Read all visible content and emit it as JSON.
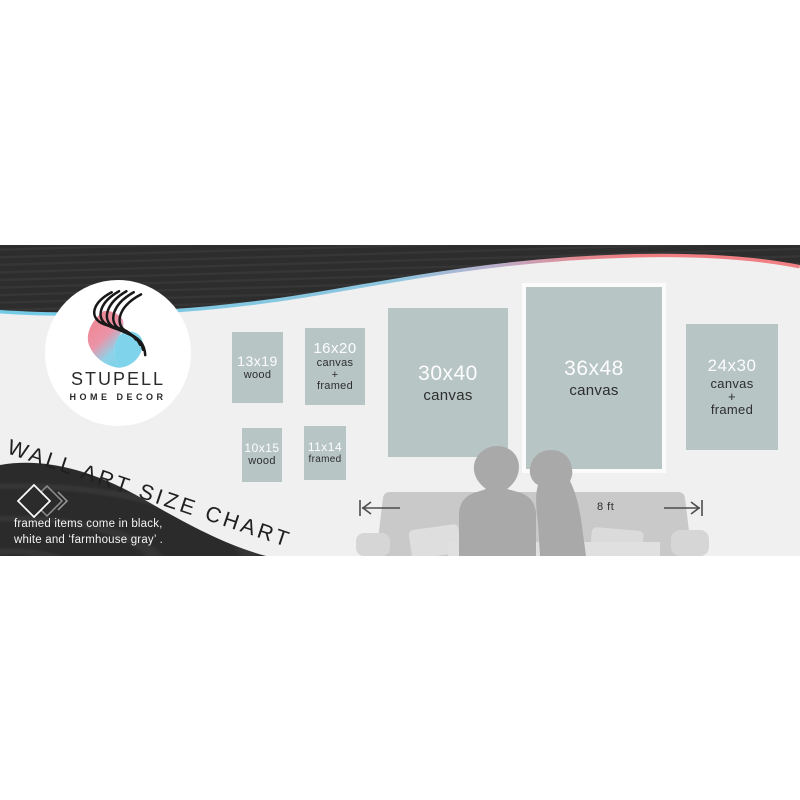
{
  "brand": {
    "name": "STUPELL",
    "tagline": "HOME DECOR"
  },
  "title": "WALL ART SIZE CHART",
  "note": {
    "line1": "framed items come in black,",
    "line2": "white and ‘farmhouse gray’ ."
  },
  "sizes": [
    {
      "size": "13x19",
      "material": "wood"
    },
    {
      "size": "16x20",
      "material": "canvas\n+\nframed"
    },
    {
      "size": "30x40",
      "material": "canvas"
    },
    {
      "size": "36x48",
      "material": "canvas"
    },
    {
      "size": "24x30",
      "material": "canvas\n+\nframed"
    },
    {
      "size": "10x15",
      "material": "wood"
    },
    {
      "size": "11x14",
      "material": "framed"
    }
  ],
  "room": {
    "scale_label": "8 ft"
  },
  "colors": {
    "banner_background": "#f0f0f1",
    "wave_dark": "#2c2c2c",
    "accent_blue": "#72cbe6",
    "accent_pink": "#ee7d80",
    "box_fill": "#b7c5c4",
    "silhouette_gray": "#a9a9a9",
    "couch_gray": "#c9c9c9"
  }
}
